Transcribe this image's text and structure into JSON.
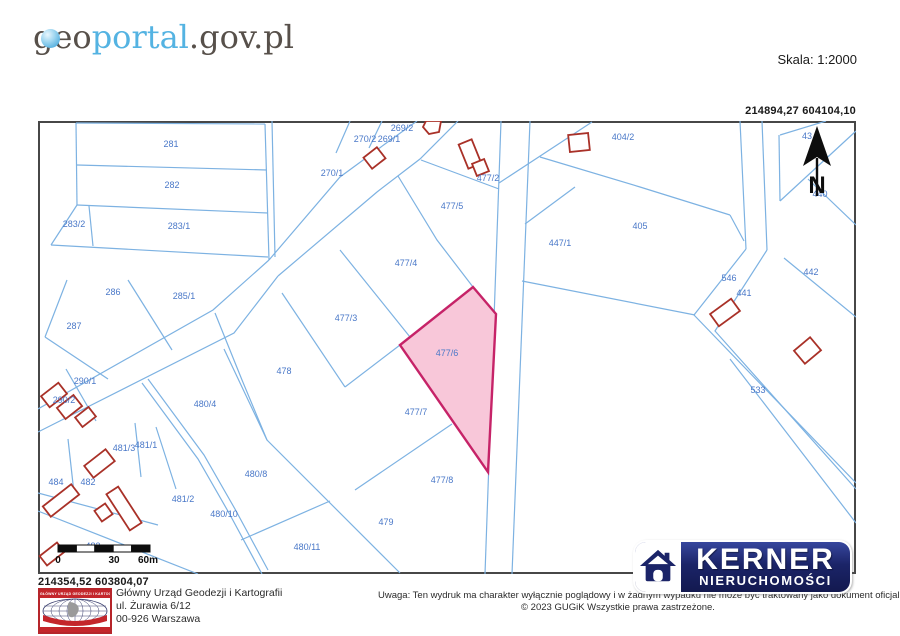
{
  "header": {
    "logo_part1": "geo",
    "logo_part2": "portal",
    "logo_part3": ".gov.pl",
    "scale_label": "Skala:  1:2000"
  },
  "coords": {
    "top_right": "214894,27   604104,10",
    "bottom_left": "214354,52   603804,07"
  },
  "footer": {
    "gugik_logo_text": "GŁÓWNY URZĄD GEODEZJI I KARTOGRAFII",
    "address_line1": "Główny Urząd Geodezji i Kartografii",
    "address_line2": "ul. Żurawia 6/12",
    "address_line3": "00-926 Warszawa",
    "notice_line1": "Uwaga: Ten wydruk ma charakter wyłącznie poglądowy i w żadnym wypadku nie może być traktowany jako dokument oficjalny.",
    "notice_line2": "© 2023 GUGiK Wszystkie prawa zastrzeżone."
  },
  "kerner": {
    "title": "KERNER",
    "subtitle": "NIERUCHOMOŚCI"
  },
  "colors": {
    "parcel_line": "#7db2e2",
    "parcel_label": "#4a78c8",
    "building": "#a93128",
    "highlight_fill": "#f8c7d9",
    "highlight_stroke": "#c62368",
    "map_border": "#474747",
    "arrow": "#0d0d0d"
  },
  "map": {
    "width": 818,
    "height": 453,
    "lines": [
      [
        38,
        2,
        227,
        3
      ],
      [
        38,
        2,
        39,
        84
      ],
      [
        227,
        3,
        231,
        139
      ],
      [
        234,
        0,
        237,
        136
      ],
      [
        39,
        44,
        229,
        49
      ],
      [
        39,
        84,
        230,
        92
      ],
      [
        39,
        84,
        13,
        124
      ],
      [
        13,
        124,
        230,
        136
      ],
      [
        51,
        85,
        55,
        125
      ],
      [
        379,
        0,
        347,
        23,
        302,
        56,
        231,
        139
      ],
      [
        420,
        0,
        382,
        38,
        339,
        71,
        240,
        155
      ],
      [
        231,
        139,
        175,
        189,
        0,
        288
      ],
      [
        240,
        155,
        196,
        212,
        0,
        311
      ],
      [
        463,
        0,
        447,
        453
      ],
      [
        492,
        0,
        474,
        453
      ],
      [
        702,
        0,
        708,
        128
      ],
      [
        724,
        0,
        729,
        129
      ],
      [
        708,
        128,
        656,
        194,
        818,
        362
      ],
      [
        729,
        129,
        677,
        210,
        818,
        368
      ],
      [
        692,
        238,
        818,
        402
      ],
      [
        554,
        1,
        461,
        62
      ],
      [
        502,
        36,
        602,
        66,
        692,
        94
      ],
      [
        537,
        66,
        487,
        103
      ],
      [
        484,
        160,
        657,
        194
      ],
      [
        692,
        94,
        706,
        120
      ],
      [
        742,
        14,
        788,
        0
      ],
      [
        742,
        80,
        818,
        10
      ],
      [
        741,
        14,
        742,
        80
      ],
      [
        770,
        58,
        818,
        104
      ],
      [
        746,
        137,
        818,
        196
      ],
      [
        360,
        55,
        399,
        119,
        435,
        166
      ],
      [
        302,
        129,
        372,
        216
      ],
      [
        244,
        172,
        307,
        266
      ],
      [
        307,
        266,
        362,
        224
      ],
      [
        186,
        228,
        229,
        319,
        362,
        452
      ],
      [
        177,
        192,
        204,
        259,
        229,
        319
      ],
      [
        317,
        369,
        414,
        303
      ],
      [
        203,
        419,
        292,
        380
      ],
      [
        383,
        39,
        461,
        68
      ],
      [
        312,
        0,
        298,
        32
      ],
      [
        344,
        0,
        331,
        27
      ],
      [
        29,
        159,
        7,
        216
      ],
      [
        7,
        216,
        70,
        258
      ],
      [
        28,
        248,
        58,
        300
      ],
      [
        90,
        159,
        134,
        229
      ],
      [
        104,
        262,
        160,
        338,
        191,
        392,
        224,
        453
      ],
      [
        110,
        258,
        166,
        334,
        197,
        388,
        230,
        449
      ],
      [
        118,
        306,
        138,
        368
      ],
      [
        97,
        302,
        103,
        356
      ],
      [
        30,
        318,
        36,
        372
      ],
      [
        0,
        372,
        120,
        404
      ],
      [
        0,
        390,
        160,
        453
      ]
    ],
    "buildings": [
      {
        "x": 425,
        "y": 20,
        "w": 14,
        "h": 26,
        "r": -22
      },
      {
        "x": 436,
        "y": 40,
        "w": 13,
        "h": 13,
        "r": -22
      },
      {
        "x": 328,
        "y": 30,
        "w": 17,
        "h": 14,
        "r": -38
      },
      {
        "x": 531,
        "y": 13,
        "w": 20,
        "h": 17,
        "r": -6
      },
      {
        "x": 674,
        "y": 184,
        "w": 26,
        "h": 15,
        "r": -36
      },
      {
        "x": 759,
        "y": 221,
        "w": 21,
        "h": 17,
        "r": -40
      },
      {
        "x": 5,
        "y": 267,
        "w": 22,
        "h": 14,
        "r": -38
      },
      {
        "x": 21,
        "y": 279,
        "w": 21,
        "h": 14,
        "r": -38
      },
      {
        "x": 39,
        "y": 290,
        "w": 17,
        "h": 12,
        "r": -38
      },
      {
        "x": 48,
        "y": 335,
        "w": 27,
        "h": 15,
        "r": -38
      },
      {
        "x": 79,
        "y": 366,
        "w": 14,
        "h": 43,
        "r": -33
      },
      {
        "x": 59,
        "y": 385,
        "w": 13,
        "h": 13,
        "r": -35
      },
      {
        "x": 5,
        "y": 373,
        "w": 36,
        "h": 13,
        "r": -38
      },
      {
        "x": 3,
        "y": 427,
        "w": 22,
        "h": 12,
        "r": -38
      }
    ],
    "building_polygons": [
      [
        388,
        0,
        403,
        0,
        401,
        11,
        391,
        13,
        385,
        6
      ]
    ],
    "highlight": {
      "points": [
        435,
        166,
        458,
        193,
        450,
        351,
        362,
        224
      ],
      "label": "477/6",
      "lx": 409,
      "ly": 235
    },
    "parcel_labels": [
      {
        "t": "281",
        "x": 133,
        "y": 26
      },
      {
        "t": "282",
        "x": 134,
        "y": 67
      },
      {
        "t": "283/2",
        "x": 36,
        "y": 106
      },
      {
        "t": "283/1",
        "x": 141,
        "y": 108
      },
      {
        "t": "269/2",
        "x": 364,
        "y": 10
      },
      {
        "t": "270/2",
        "x": 327,
        "y": 21
      },
      {
        "t": "269/1",
        "x": 351,
        "y": 21
      },
      {
        "t": "270/1",
        "x": 294,
        "y": 55
      },
      {
        "t": "477/2",
        "x": 450,
        "y": 60
      },
      {
        "t": "477/5",
        "x": 414,
        "y": 88
      },
      {
        "t": "404/2",
        "x": 585,
        "y": 19
      },
      {
        "t": "405",
        "x": 602,
        "y": 108
      },
      {
        "t": "447/1",
        "x": 522,
        "y": 125
      },
      {
        "t": "440",
        "x": 782,
        "y": 76
      },
      {
        "t": "442",
        "x": 773,
        "y": 154
      },
      {
        "t": "441",
        "x": 706,
        "y": 175
      },
      {
        "t": "546",
        "x": 691,
        "y": 160
      },
      {
        "t": "533",
        "x": 720,
        "y": 272
      },
      {
        "t": "286",
        "x": 75,
        "y": 174
      },
      {
        "t": "285/1",
        "x": 146,
        "y": 178
      },
      {
        "t": "287",
        "x": 36,
        "y": 208
      },
      {
        "t": "290/1",
        "x": 47,
        "y": 263
      },
      {
        "t": "290/2",
        "x": 26,
        "y": 282
      },
      {
        "t": "477/4",
        "x": 368,
        "y": 145
      },
      {
        "t": "477/3",
        "x": 308,
        "y": 200
      },
      {
        "t": "478",
        "x": 246,
        "y": 253
      },
      {
        "t": "480/4",
        "x": 167,
        "y": 286
      },
      {
        "t": "477/7",
        "x": 378,
        "y": 294
      },
      {
        "t": "481/3",
        "x": 86,
        "y": 330
      },
      {
        "t": "481/1",
        "x": 108,
        "y": 327
      },
      {
        "t": "484",
        "x": 18,
        "y": 364
      },
      {
        "t": "482",
        "x": 50,
        "y": 364
      },
      {
        "t": "480/8",
        "x": 218,
        "y": 356
      },
      {
        "t": "477/8",
        "x": 404,
        "y": 362
      },
      {
        "t": "481/2",
        "x": 145,
        "y": 381
      },
      {
        "t": "480/10",
        "x": 186,
        "y": 396
      },
      {
        "t": "479",
        "x": 348,
        "y": 404
      },
      {
        "t": "483",
        "x": 55,
        "y": 428
      },
      {
        "t": "480/11",
        "x": 269,
        "y": 429
      }
    ],
    "partial_label": {
      "t": "43",
      "x": 769,
      "y": 18
    },
    "north_arrow": {
      "head": [
        779,
        5,
        765,
        45,
        779,
        36,
        793,
        45
      ],
      "stem": [
        779,
        37,
        779,
        75
      ],
      "label": "N",
      "lx": 779,
      "ly": 72
    },
    "scalebar": {
      "x": 20,
      "y": 424,
      "h": 7,
      "seg_w": 18.4,
      "segments": 5,
      "labels": [
        {
          "t": "0",
          "x": 20
        },
        {
          "t": "30",
          "x": 76
        },
        {
          "t": "60m",
          "x": 110
        }
      ],
      "label_y": 442
    }
  }
}
